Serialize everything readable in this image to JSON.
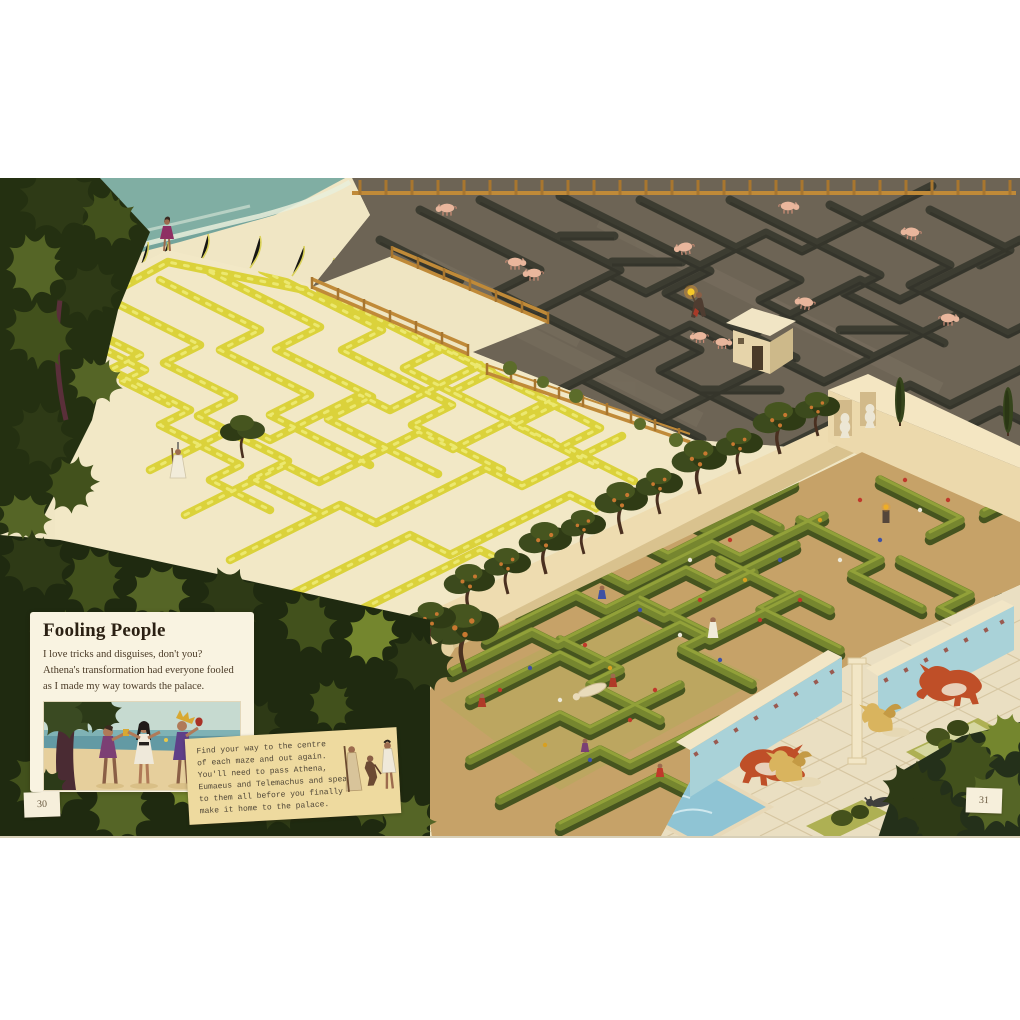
{
  "info_box": {
    "title": "Fooling People",
    "line1": "I love tricks and disguises, don't you?",
    "line2": "Athena's transformation had everyone fooled",
    "line3": "as I made my way towards the palace."
  },
  "task_note": {
    "line1": "Find your way to the centre",
    "line2": "of each maze and out again.",
    "line3": "You'll need to pass Athena,",
    "line4": "Eumaeus and Telemachus and speak",
    "line5": "to them all before you finally",
    "line6": "make it home to the palace."
  },
  "pages": {
    "left": "30",
    "right": "31"
  },
  "scene": {
    "mazes": [
      {
        "name": "sand-dune-maze",
        "wall_color": "#dbd23b",
        "ground_color": "#f2e8c6"
      },
      {
        "name": "pig-pen-maze",
        "wall_color": "#3c3c31",
        "ground_color": "#6d6455"
      },
      {
        "name": "palace-garden-maze",
        "wall_color": "#76862f",
        "ground_color": "#c6a268"
      }
    ],
    "palette": {
      "sea": "#74a49b",
      "fence": "#c08a38",
      "wall_cream": "#eedcb0",
      "fresco_blue": "#a9d2d8",
      "bull_red": "#bf4f28",
      "griffin_gold": "#d9b45e",
      "foliage_dark": "#243011",
      "note_paper": "#eeda9f",
      "box_paper": "#f9f3e1",
      "pig_pink": "#e9b69c"
    }
  }
}
